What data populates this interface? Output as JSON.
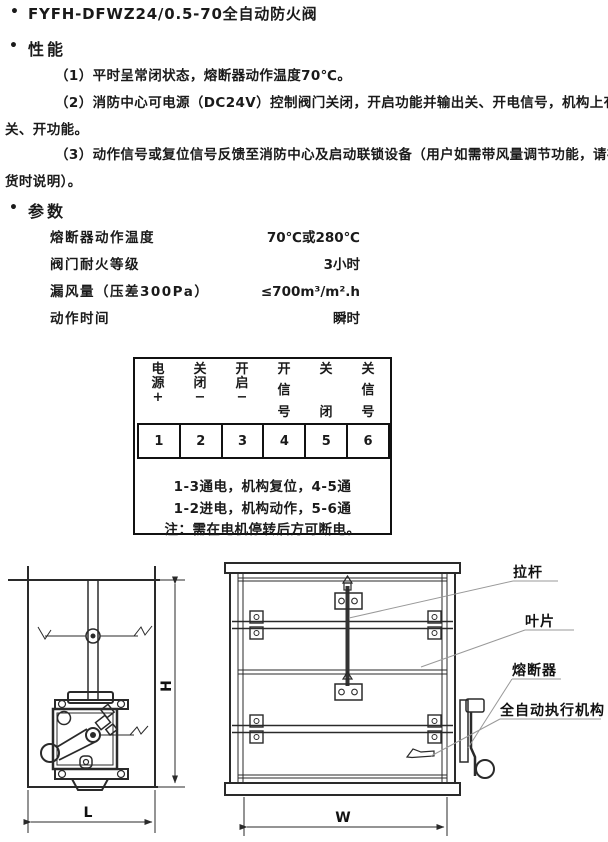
{
  "title": {
    "bullet": "•",
    "text": "FYFH-DFWZ24/0.5-70全自动防火阀"
  },
  "performance": {
    "bullet": "•",
    "heading": "性能",
    "items": [
      {
        "lines": [
          "（1）平时呈常闭状态，熔断器动作温度70℃。"
        ]
      },
      {
        "lines": [
          "（2）消防中心可电源（DC24V）控制阀门关闭，开启功能并输出关、开电信号，机构上有手动可",
          "关、开功能。"
        ]
      },
      {
        "lines": [
          "（3）动作信号或复位信号反馈至消防中心及启动联锁设备（用户如需带风量调节功能，请在订",
          "货时说明）。"
        ]
      }
    ]
  },
  "parameters": {
    "bullet": "•",
    "heading": "参数",
    "rows": [
      {
        "label": "熔断器动作温度",
        "value": "70℃或280℃"
      },
      {
        "label": "阀门耐火等级",
        "value": "3小时"
      },
      {
        "label": "漏风量（压差300Pa）",
        "value": "≤700m³/m².h"
      },
      {
        "label": "动作时间",
        "value": "瞬时"
      }
    ]
  },
  "terminal_table": {
    "header_columns": [
      {
        "chars": [
          "电",
          "源",
          "+"
        ]
      },
      {
        "chars": [
          "关",
          "闭",
          "−"
        ]
      },
      {
        "chars": [
          "开",
          "启",
          "−"
        ]
      },
      {
        "chars": [
          "开",
          "信",
          "号"
        ]
      },
      {
        "chars": [
          "关",
          "",
          "闭"
        ]
      },
      {
        "chars": [
          "关",
          "信",
          "号"
        ]
      }
    ],
    "terminal_numbers": [
      "1",
      "2",
      "3",
      "4",
      "5",
      "6"
    ],
    "notes": [
      "1-3通电，机构复位，4-5通",
      "1-2进电，机构动作，5-6通",
      "注：需在电机停转后方可断电。"
    ]
  },
  "diagrams": {
    "side_view": {
      "dim_height_label": "H",
      "dim_width_label": "L"
    },
    "front_view": {
      "dim_width_label": "W",
      "part_labels": [
        "拉杆",
        "叶片",
        "熔断器",
        "全自动执行机构"
      ]
    }
  }
}
